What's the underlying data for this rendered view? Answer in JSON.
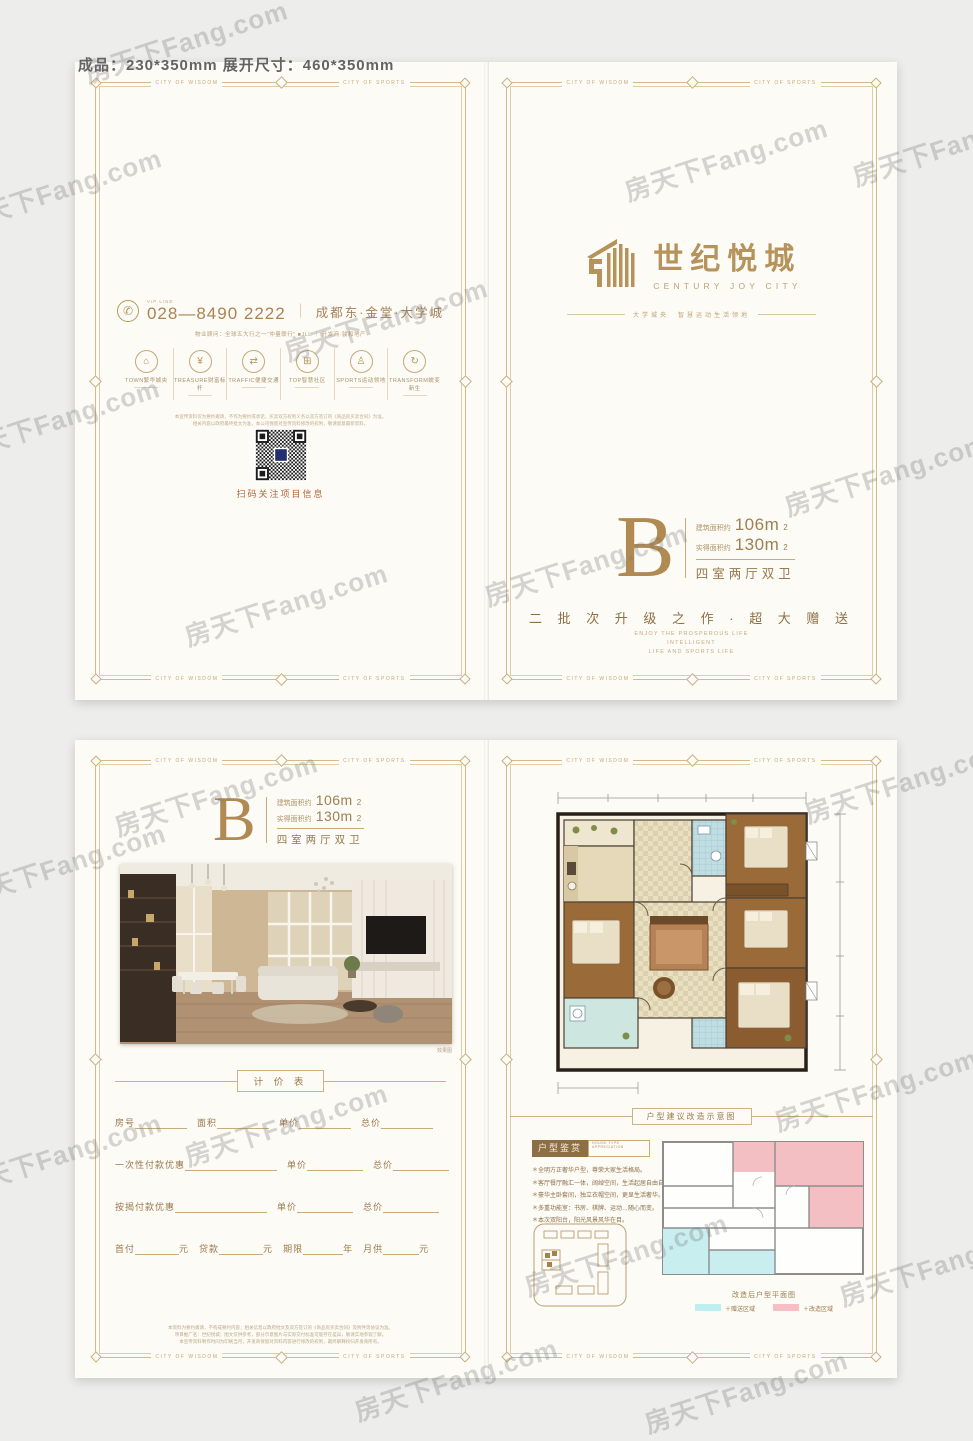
{
  "meta": {
    "size_note": "成品：230*350mm 展开尺寸：460*350mm"
  },
  "watermark": {
    "text": "房天下Fang.com"
  },
  "border": {
    "wisdom": "CITY OF WISDOM",
    "sports": "CITY OF SPORTS"
  },
  "theme": {
    "gold": "#b6935a",
    "brown": "#8d6f46",
    "paper": "#fcfbf5",
    "cyan": "#bfeef0",
    "pink": "#f5bfc3"
  },
  "brand": {
    "name_cn": "世纪悦城",
    "name_en": "CENTURY JOY CITY",
    "tagline": "大学城央　智慧运动生活领地"
  },
  "unit": {
    "letter": "B",
    "a1_label": "建筑面积约",
    "a1_value": "106m",
    "a2_label": "实得面积约",
    "a2_value": "130m",
    "sup": "2",
    "layout": "四室两厅双卫"
  },
  "cover": {
    "slogan": "二 批 次 升 级 之 作 · 超 大 赠 送",
    "slogan_en": [
      "ENJOY THE PROSPEROUS LIFE",
      "INTELLIGENT",
      "LIFE AND SPORTS LIFE"
    ]
  },
  "back": {
    "phone_glyph": "✆",
    "vip_label": "VIP LINE",
    "phone": "028—8490 2222",
    "divider": "｜",
    "location": "成都东·金堂·大学城",
    "agency": "物业顾问：全球五大行之一“仲量联行” ■JLL ｜ 开发商·骏和地产",
    "features": [
      {
        "glyph": "⌂",
        "label": "TOWN繁华城央"
      },
      {
        "glyph": "¥",
        "label": "TREASURE财富标杆"
      },
      {
        "glyph": "⇄",
        "label": "TRAFFIC便捷交通"
      },
      {
        "glyph": "⊞",
        "label": "TOP智慧社区"
      },
      {
        "glyph": "♙",
        "label": "SPORTS运动领地"
      },
      {
        "glyph": "↻",
        "label": "TRANSFORM蜕变新生"
      }
    ],
    "disclaimer1": "本宣传资料仅为要约邀请，不作为要约或承诺，买卖双方权利义务以双方签订的《商品房买卖合同》为准。",
    "disclaimer2": "相关内容以政府最终批文为准，本公司保留对宣传资料修改的权利，敬请留意最新资料。",
    "qr_caption": "扫码关注项目信息"
  },
  "inner": {
    "photo_caption": "效果图",
    "legal": [
      "本资料为要约邀请，不构成要约内容；相关信息以政府批文及双方签订的《商品房买卖合同》及附件等协议为准。",
      "项目推广名：世纪悦城；图文仅供参考，部分示意图片与实际交付标准可能存在差异，敬请实地参观了解。",
      "本宣传资料制作时间为印刷当月，开发商保留对资料内容进行修改的权利，最终解释权归开发商所有。"
    ]
  },
  "price_table": {
    "title": "计 价 表",
    "r1": [
      "房号",
      "面积",
      "单价",
      "总价"
    ],
    "r2": [
      "一次性付款优惠",
      "单价",
      "总价"
    ],
    "r3": [
      "按揭付款优惠",
      "单价",
      "总价"
    ],
    "r4_labels": [
      "首付",
      "贷款",
      "期限",
      "月供"
    ],
    "r4_units": [
      "元",
      "元",
      "年",
      "元"
    ]
  },
  "reno": {
    "divider": "户型建议改造示意图",
    "title": "户型鉴赏",
    "sub1": "HOUSE TYPE",
    "sub2": "APPRECIATION",
    "bullets": [
      "＊全明方正奢华户型，尊荣大家生活格局。",
      "＊客厅餐厅融汇一体，阔绰空间，生活起居自由自在。",
      "＊豪华主卧套间，独立衣帽空间，更显生活奢华。",
      "＊多重功能室：书房、棋牌、运动…随心而变。",
      "＊本次双阳台，阳光风景风华在目。"
    ],
    "plan_caption": "改造后户型平面图",
    "legend0_style": "background:#bfeef0",
    "legend0_label": "＋赠送区域",
    "legend1_style": "background:#f5bfc3",
    "legend1_label": "＋改造区域"
  }
}
